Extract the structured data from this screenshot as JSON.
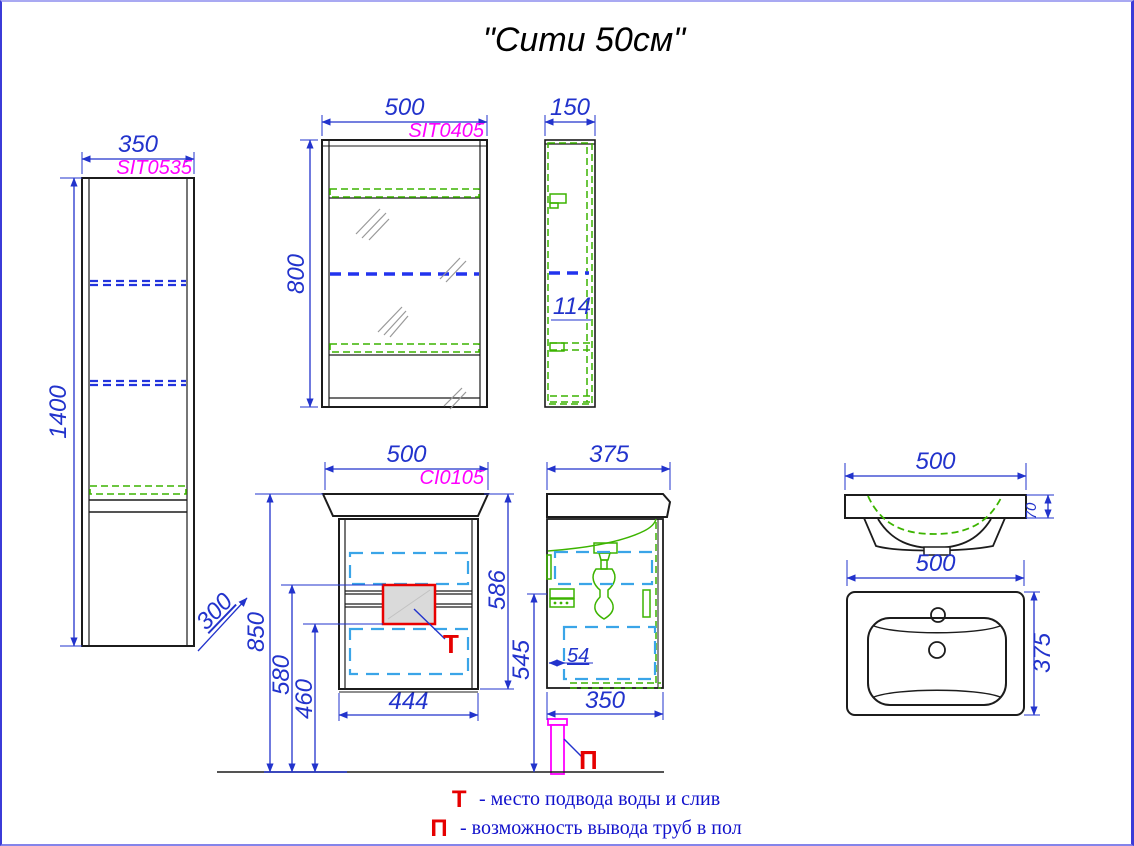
{
  "title": "\"Сити 50см\"",
  "tall_cabinet": {
    "code": "SIT0535",
    "width": "350",
    "height": "1400",
    "depth": "300"
  },
  "mirror_cabinet": {
    "code": "SIT0405",
    "width": "500",
    "height": "800",
    "depth": "150",
    "shelf_gap": "114"
  },
  "vanity": {
    "code": "CI0105",
    "width": "500",
    "height": "586",
    "inner_width": "444",
    "mount_height": "850",
    "supply_top": "580",
    "supply_bottom": "460",
    "depth": "375",
    "drain_offset": "54",
    "drain_height": "545",
    "body_depth": "350",
    "water_marker": "Т",
    "pipe_marker": "П"
  },
  "sink": {
    "width": "500",
    "rim_height": "70",
    "top_width": "500",
    "top_depth": "375"
  },
  "legend": [
    {
      "symbol": "Т",
      "text": "- место подвода воды и слив"
    },
    {
      "symbol": "П",
      "text": "- возможность вывода труб в пол"
    }
  ],
  "colors": {
    "dimension": "#2233cc",
    "code": "#ff00ff",
    "hardware": "#3cb400",
    "drawer": "#3aa5e8",
    "marker": "#e60000",
    "outline": "#1c1c1c",
    "border": "#3b3bd8"
  }
}
